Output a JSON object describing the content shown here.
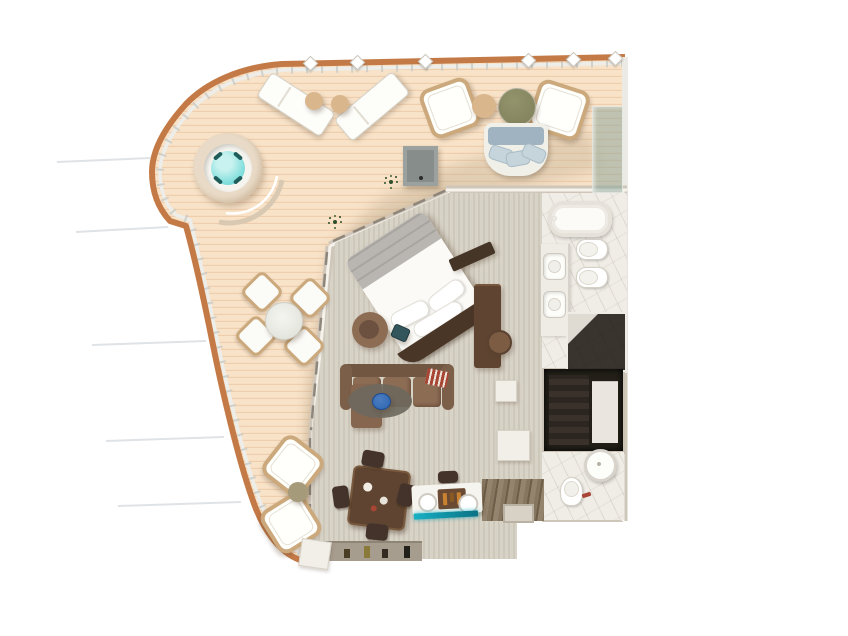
{
  "scene": {
    "type": "3d-floor-plan-top-view",
    "visible_text": [],
    "rooms": [
      {
        "id": "balcony-terrace",
        "floor": "wood-deck",
        "items": [
          "hot-tub",
          "curved-bench",
          "sun-lounger",
          "sun-lounger",
          "side-table",
          "side-table",
          "wicker-armchair",
          "wicker-armchair",
          "coffee-table-round",
          "side-table-round",
          "outdoor-sofa",
          "planter-table",
          "glass-wind-screen",
          "plant",
          "plant",
          "dining-table-round",
          "deck-chair",
          "deck-chair",
          "deck-chair",
          "deck-chair",
          "wicker-armchair",
          "wicker-armchair",
          "low-table",
          "railing-with-balusters"
        ]
      },
      {
        "id": "bedroom",
        "floor": "carpet",
        "items": [
          "double-bed-angled",
          "pillows",
          "folded-blanket",
          "curved-headboard",
          "swivel-armchair",
          "teal-stool",
          "tv-dresser",
          "desk",
          "desk-chair"
        ]
      },
      {
        "id": "living-room",
        "floor": "carpet",
        "items": [
          "sectional-sofa-with-chaise",
          "striped-throw",
          "oval-rug",
          "blue-pouf",
          "dining-table-square",
          "dining-chair",
          "dining-chair",
          "dining-chair",
          "dining-chair",
          "bar-console",
          "bar-tray",
          "minibar-glow-shelf",
          "stool",
          "decor-shelf-with-figurines"
        ]
      },
      {
        "id": "master-bathroom",
        "floor": "marble",
        "items": [
          "bathtub",
          "double-sink-vanity",
          "toilet",
          "bidet",
          "walk-in-shower"
        ]
      },
      {
        "id": "walk-in-closet",
        "floor": "carpet",
        "items": [
          "hanging-clothes",
          "shelving-unit"
        ]
      },
      {
        "id": "guest-bathroom",
        "floor": "marble",
        "items": [
          "toilet",
          "round-basin",
          "red-towel"
        ]
      },
      {
        "id": "entry-hall",
        "floor": "wood-strip",
        "items": [
          "door-mat",
          "storage-block",
          "storage-block"
        ]
      },
      {
        "id": "corridor",
        "floor": "carpet",
        "items": []
      }
    ],
    "exterior": [
      "ship-hull-ghost-lines"
    ]
  },
  "colors": {
    "deck": "#f8e3c9",
    "deckLine": "#ecc9a6",
    "deckTrim": "#e8dac6",
    "walkway": "#c8b497",
    "cap": "#c47a46",
    "rail": "#ededea",
    "baluster": "#c9c9c4",
    "carpet": "#d8d3c7",
    "carpetLine": "#cec8bb",
    "wall": "#cfc6ba",
    "wallCap": "#f6f3ed",
    "glassLine": "#8e867a",
    "marble": "#f0ede6",
    "wood": "#5f4531",
    "woodDark": "#44332a",
    "sofa": "#8d6c54",
    "sofaDark": "#715641",
    "bedWhite": "#fbfaf6",
    "blanket": "#b9b6b1",
    "headboard": "#4a3626",
    "water": "#84dfdd",
    "wicker": "#cba97c",
    "tan": "#d9b68c",
    "olive": "#85855f",
    "blueCushion": "#9fb4c0",
    "tealGlow": "#17b0c4",
    "rug": "#6e685d",
    "pouf": "#2f66b0",
    "entryWood": "#87765f",
    "dark": "#242019",
    "glass": "rgba(143,168,155,0.55)",
    "planter": "#9aa19f",
    "accentRed": "#a84636",
    "plant": "#2e4d2a",
    "hull": "#dfe3e6"
  }
}
